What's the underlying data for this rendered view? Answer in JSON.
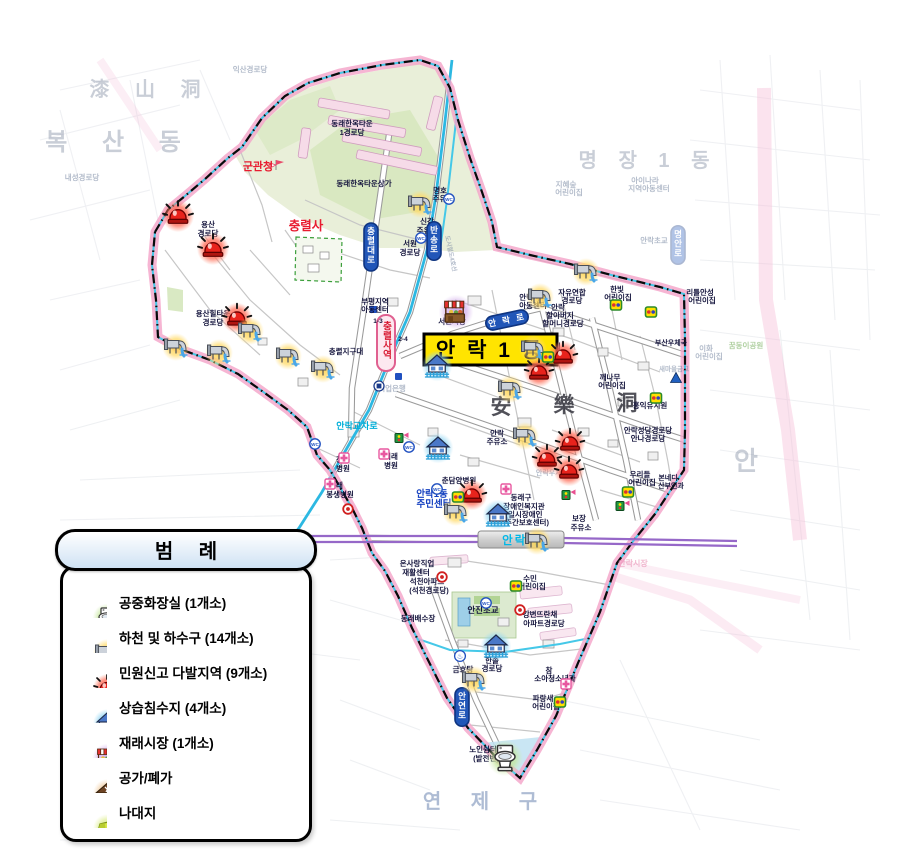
{
  "title": "안 락 1 동",
  "legend": {
    "title": "범 례",
    "items": [
      {
        "icon": "toilet",
        "label": "공중화장실 (1개소)"
      },
      {
        "icon": "drain",
        "label": "하천 및 하수구 (14개소)"
      },
      {
        "icon": "siren",
        "label": "민원신고 다발지역 (9개소)"
      },
      {
        "icon": "flood",
        "label": "상습침수지 (4개소)"
      },
      {
        "icon": "market",
        "label": "재래시장 (1개소)"
      },
      {
        "icon": "vacant-house",
        "label": "공가/폐가"
      },
      {
        "icon": "vacant-land",
        "label": "나대지"
      }
    ]
  },
  "icons": {
    "wc": "WC",
    "bath": "♨"
  },
  "map": {
    "stations": [
      {
        "name": "충렬사역",
        "line": "도시철도4호선"
      },
      {
        "name": "안락역"
      }
    ],
    "road_signs": [
      {
        "text": "안락로",
        "x": 507,
        "y": 320,
        "rot": -12
      },
      {
        "text": "충렬대로",
        "x": 371,
        "y": 247,
        "vert": true
      },
      {
        "text": "반송로",
        "x": 434,
        "y": 241,
        "vert": true
      },
      {
        "text": "안연로",
        "x": 462,
        "y": 707,
        "vert": true
      },
      {
        "text": "명안로",
        "x": 678,
        "y": 245,
        "vert": true,
        "faded": true
      }
    ],
    "labels": [
      {
        "t": "복 산 동",
        "x": 120,
        "y": 150,
        "c": "bg",
        "s": 24,
        "ls": 14
      },
      {
        "t": "漆 山 洞",
        "x": 150,
        "y": 96,
        "c": "bg",
        "s": 20,
        "ls": 10
      },
      {
        "t": "명 장 1 동",
        "x": 648,
        "y": 167,
        "c": "bg",
        "s": 20,
        "ls": 8
      },
      {
        "t": "안",
        "x": 746,
        "y": 470,
        "c": "bg",
        "s": 26
      },
      {
        "t": "연 제 구",
        "x": 486,
        "y": 808,
        "c": "bgb",
        "s": 20,
        "ls": 12
      },
      {
        "t": "安",
        "x": 501,
        "y": 414,
        "c": "hanja",
        "s": 21
      },
      {
        "t": "樂",
        "x": 564,
        "y": 412,
        "c": "hanja",
        "s": 21
      },
      {
        "t": "洞",
        "x": 627,
        "y": 410,
        "c": "hanja",
        "s": 21
      },
      {
        "t": "군관청",
        "x": 258,
        "y": 170,
        "c": "red",
        "s": 11
      },
      {
        "t": "충렬사",
        "x": 306,
        "y": 230,
        "c": "red",
        "s": 12.5
      },
      {
        "t": "안락교차로",
        "x": 357,
        "y": 429,
        "c": "cyan",
        "s": 9
      },
      {
        "t": "안락1동",
        "x": 432,
        "y": 497,
        "c": "blue",
        "s": 9.5
      },
      {
        "t": "주민센터",
        "x": 434,
        "y": 507,
        "c": "blue",
        "s": 9.5
      },
      {
        "t": "동래한옥타운",
        "x": 352,
        "y": 126,
        "c": "f",
        "s": 7.5
      },
      {
        "t": "1경로당",
        "x": 352,
        "y": 135,
        "c": "f",
        "s": 7.5
      },
      {
        "t": "동래한옥타운상가",
        "x": 364,
        "y": 186,
        "c": "f",
        "s": 7.5
      },
      {
        "t": "용산",
        "x": 208,
        "y": 227,
        "c": "f",
        "s": 7.5
      },
      {
        "t": "경로당",
        "x": 208,
        "y": 236,
        "c": "f",
        "s": 7.5
      },
      {
        "t": "용산힐타운",
        "x": 213,
        "y": 316,
        "c": "f",
        "s": 7.5
      },
      {
        "t": "경로당",
        "x": 213,
        "y": 325,
        "c": "f",
        "s": 7.5
      },
      {
        "t": "명호",
        "x": 440,
        "y": 193,
        "c": "f",
        "s": 7.5
      },
      {
        "t": "주유소",
        "x": 443,
        "y": 201,
        "c": "f",
        "s": 7.5
      },
      {
        "t": "신강",
        "x": 427,
        "y": 224,
        "c": "f",
        "s": 7.5
      },
      {
        "t": "주유소",
        "x": 427,
        "y": 233,
        "c": "f",
        "s": 7.5
      },
      {
        "t": "서원",
        "x": 410,
        "y": 246,
        "c": "f",
        "s": 7.5
      },
      {
        "t": "경로당",
        "x": 410,
        "y": 255,
        "c": "f",
        "s": 7.5
      },
      {
        "t": "부평지역",
        "x": 375,
        "y": 304,
        "c": "f",
        "s": 7.5
      },
      {
        "t": "아동센터",
        "x": 375,
        "y": 312,
        "c": "f",
        "s": 7.5
      },
      {
        "t": "1-3",
        "x": 378,
        "y": 323,
        "c": "f",
        "s": 6.5
      },
      {
        "t": "2-4",
        "x": 403,
        "y": 341,
        "c": "f",
        "s": 6.5
      },
      {
        "t": "도시철도4호선",
        "x": 449,
        "y": 254,
        "c": "fd",
        "s": 6,
        "r": 78
      },
      {
        "t": "충렬지구대",
        "x": 346,
        "y": 354,
        "c": "f",
        "s": 7.5
      },
      {
        "t": "기업은행",
        "x": 392,
        "y": 391,
        "c": "fd",
        "s": 7.5
      },
      {
        "t": "서원시장",
        "x": 452,
        "y": 324,
        "c": "f",
        "s": 7.5
      },
      {
        "t": "안락지역",
        "x": 533,
        "y": 300,
        "c": "f",
        "s": 7.5
      },
      {
        "t": "아동센터",
        "x": 533,
        "y": 308,
        "c": "f",
        "s": 7.5
      },
      {
        "t": "자유연합",
        "x": 572,
        "y": 295,
        "c": "f",
        "s": 7.5
      },
      {
        "t": "경로당",
        "x": 572,
        "y": 303,
        "c": "f",
        "s": 7.5
      },
      {
        "t": "한빛",
        "x": 617,
        "y": 292,
        "c": "f",
        "s": 7.5
      },
      {
        "t": "어린이집",
        "x": 618,
        "y": 300,
        "c": "f",
        "s": 7.5
      },
      {
        "t": "안락",
        "x": 558,
        "y": 310,
        "c": "f",
        "s": 7.5
      },
      {
        "t": "할아버지",
        "x": 560,
        "y": 318,
        "c": "f",
        "s": 7.5
      },
      {
        "t": "할머니경로당",
        "x": 563,
        "y": 326,
        "c": "f",
        "s": 7.5
      },
      {
        "t": "리틀안성",
        "x": 700,
        "y": 295,
        "c": "f",
        "s": 7.5
      },
      {
        "t": "어린이집",
        "x": 702,
        "y": 303,
        "c": "f",
        "s": 7.5
      },
      {
        "t": "꾸러기",
        "x": 545,
        "y": 341,
        "c": "f",
        "s": 7.5
      },
      {
        "t": "어린이집",
        "x": 547,
        "y": 349,
        "c": "f",
        "s": 7.5
      },
      {
        "t": "깨나무",
        "x": 610,
        "y": 380,
        "c": "f",
        "s": 7.5
      },
      {
        "t": "어린이집",
        "x": 612,
        "y": 388,
        "c": "f",
        "s": 7.5
      },
      {
        "t": "홍익유치원",
        "x": 650,
        "y": 408,
        "c": "f",
        "s": 7.5
      },
      {
        "t": "부산우체국",
        "x": 671,
        "y": 345,
        "c": "f",
        "s": 7
      },
      {
        "t": "새마을금고",
        "x": 674,
        "y": 371,
        "c": "fd",
        "s": 6.5
      },
      {
        "t": "안락성당경로당",
        "x": 648,
        "y": 433,
        "c": "f",
        "s": 7.5
      },
      {
        "t": "안나경로당",
        "x": 648,
        "y": 441,
        "c": "f",
        "s": 7.5
      },
      {
        "t": "우리들",
        "x": 640,
        "y": 477,
        "c": "f",
        "s": 7.5
      },
      {
        "t": "어린이집",
        "x": 642,
        "y": 485,
        "c": "f",
        "s": 7.5
      },
      {
        "t": "본네디",
        "x": 668,
        "y": 480,
        "c": "f",
        "s": 7
      },
      {
        "t": "산부인과",
        "x": 671,
        "y": 488,
        "c": "f",
        "s": 7
      },
      {
        "t": "안락",
        "x": 497,
        "y": 436,
        "c": "f",
        "s": 7.5
      },
      {
        "t": "주유소",
        "x": 497,
        "y": 444,
        "c": "f",
        "s": 7.5
      },
      {
        "t": "안락우체국",
        "x": 552,
        "y": 475,
        "c": "fd",
        "s": 7
      },
      {
        "t": "미래",
        "x": 391,
        "y": 459,
        "c": "f",
        "s": 7.5
      },
      {
        "t": "병원",
        "x": 391,
        "y": 468,
        "c": "f",
        "s": 7.5
      },
      {
        "t": "창운",
        "x": 343,
        "y": 462,
        "c": "f",
        "s": 7.5
      },
      {
        "t": "병원",
        "x": 343,
        "y": 471,
        "c": "f",
        "s": 7.5
      },
      {
        "t": "동래",
        "x": 336,
        "y": 488,
        "c": "f",
        "s": 7.5
      },
      {
        "t": "봉생병원",
        "x": 340,
        "y": 497,
        "c": "f",
        "s": 7.5
      },
      {
        "t": "춘담양병원",
        "x": 459,
        "y": 483,
        "c": "f",
        "s": 7.5
      },
      {
        "t": "동래구",
        "x": 521,
        "y": 500,
        "c": "f",
        "s": 7.5
      },
      {
        "t": "장애인복지관",
        "x": 524,
        "y": 509,
        "c": "f",
        "s": 7.5
      },
      {
        "t": "(일시장애인",
        "x": 524,
        "y": 517,
        "c": "f",
        "s": 7.5
      },
      {
        "t": "주간보호센터)",
        "x": 527,
        "y": 525,
        "c": "f",
        "s": 7.5
      },
      {
        "t": "보장",
        "x": 579,
        "y": 521,
        "c": "f",
        "s": 7.5
      },
      {
        "t": "주유소",
        "x": 581,
        "y": 530,
        "c": "f",
        "s": 7.5
      },
      {
        "t": "온사랑직업",
        "x": 417,
        "y": 566,
        "c": "f",
        "s": 7.5
      },
      {
        "t": "재활센터",
        "x": 416,
        "y": 575,
        "c": "f",
        "s": 7.5
      },
      {
        "t": "석천아파트",
        "x": 427,
        "y": 584,
        "c": "f",
        "s": 7.5
      },
      {
        "t": "(석천경로당)",
        "x": 429,
        "y": 593,
        "c": "f",
        "s": 7.5
      },
      {
        "t": "수민",
        "x": 530,
        "y": 581,
        "c": "f",
        "s": 7.5
      },
      {
        "t": "어린이집",
        "x": 532,
        "y": 589,
        "c": "f",
        "s": 7.5
      },
      {
        "t": "안진초교",
        "x": 483,
        "y": 613,
        "c": "f",
        "s": 8.5
      },
      {
        "t": "동래배수장",
        "x": 418,
        "y": 621,
        "c": "f",
        "s": 7.5
      },
      {
        "t": "강변뜨란채",
        "x": 540,
        "y": 617,
        "c": "f",
        "s": 7.5
      },
      {
        "t": "아파트경로당",
        "x": 544,
        "y": 626,
        "c": "f",
        "s": 7.5
      },
      {
        "t": "금호탕",
        "x": 463,
        "y": 672,
        "c": "f",
        "s": 7.5
      },
      {
        "t": "한솔",
        "x": 492,
        "y": 663,
        "c": "f",
        "s": 7.5
      },
      {
        "t": "경로당",
        "x": 492,
        "y": 671,
        "c": "f",
        "s": 7.5
      },
      {
        "t": "참",
        "x": 549,
        "y": 673,
        "c": "f",
        "s": 7.5
      },
      {
        "t": "소아청소년과",
        "x": 555,
        "y": 681,
        "c": "f",
        "s": 7.5
      },
      {
        "t": "파랑새",
        "x": 543,
        "y": 701,
        "c": "f",
        "s": 7.5
      },
      {
        "t": "어린이집",
        "x": 546,
        "y": 709,
        "c": "f",
        "s": 7.5
      },
      {
        "t": "노인쉼터",
        "x": 483,
        "y": 752,
        "c": "f",
        "s": 7.5
      },
      {
        "t": "(발전변)",
        "x": 486,
        "y": 761,
        "c": "f",
        "s": 7.5
      },
      {
        "t": "익산경로당",
        "x": 250,
        "y": 72,
        "c": "fd",
        "s": 7.5
      },
      {
        "t": "내성경로당",
        "x": 82,
        "y": 180,
        "c": "fd",
        "s": 7.5
      },
      {
        "t": "아이나라",
        "x": 645,
        "y": 183,
        "c": "fd",
        "s": 7.5
      },
      {
        "t": "지역아동센터",
        "x": 649,
        "y": 191,
        "c": "fd",
        "s": 7.5
      },
      {
        "t": "지혜숲",
        "x": 566,
        "y": 187,
        "c": "fd",
        "s": 7.5
      },
      {
        "t": "어린이집",
        "x": 569,
        "y": 195,
        "c": "fd",
        "s": 7.5
      },
      {
        "t": "안락초교",
        "x": 654,
        "y": 243,
        "c": "fd",
        "s": 7.5
      },
      {
        "t": "이화",
        "x": 706,
        "y": 351,
        "c": "fd",
        "s": 7.5
      },
      {
        "t": "어린이집",
        "x": 709,
        "y": 359,
        "c": "fd",
        "s": 7.5
      },
      {
        "t": "꿈동이공원",
        "x": 746,
        "y": 348,
        "c": "fdg",
        "s": 7.5
      },
      {
        "t": "안락시장",
        "x": 633,
        "y": 566,
        "c": "fdp",
        "s": 8
      }
    ],
    "markers": [
      {
        "k": "siren",
        "x": 178,
        "y": 216,
        "s": 1.15
      },
      {
        "k": "siren",
        "x": 213,
        "y": 249,
        "s": 1.15
      },
      {
        "k": "siren",
        "x": 237,
        "y": 318,
        "s": 1.1
      },
      {
        "k": "siren",
        "x": 539,
        "y": 372,
        "s": 1.1
      },
      {
        "k": "siren",
        "x": 563,
        "y": 356,
        "s": 1.1
      },
      {
        "k": "siren",
        "x": 570,
        "y": 443,
        "s": 1.1
      },
      {
        "k": "siren",
        "x": 547,
        "y": 459,
        "s": 1.1
      },
      {
        "k": "siren",
        "x": 569,
        "y": 471,
        "s": 1.1
      },
      {
        "k": "siren",
        "x": 472,
        "y": 495,
        "s": 1.1
      },
      {
        "k": "drain",
        "x": 420,
        "y": 204
      },
      {
        "k": "drain",
        "x": 586,
        "y": 272
      },
      {
        "k": "drain",
        "x": 540,
        "y": 297
      },
      {
        "k": "drain",
        "x": 533,
        "y": 349
      },
      {
        "k": "drain",
        "x": 510,
        "y": 389
      },
      {
        "k": "drain",
        "x": 250,
        "y": 331
      },
      {
        "k": "drain",
        "x": 288,
        "y": 356
      },
      {
        "k": "drain",
        "x": 323,
        "y": 369
      },
      {
        "k": "drain",
        "x": 176,
        "y": 347
      },
      {
        "k": "drain",
        "x": 219,
        "y": 353
      },
      {
        "k": "drain",
        "x": 525,
        "y": 436
      },
      {
        "k": "drain",
        "x": 456,
        "y": 512
      },
      {
        "k": "drain",
        "x": 537,
        "y": 541
      },
      {
        "k": "drain",
        "x": 474,
        "y": 680
      },
      {
        "k": "flood",
        "x": 437,
        "y": 366,
        "s": 1.1
      },
      {
        "k": "flood",
        "x": 438,
        "y": 448,
        "s": 1.1
      },
      {
        "k": "flood",
        "x": 498,
        "y": 515,
        "s": 1.1
      },
      {
        "k": "flood",
        "x": 496,
        "y": 646,
        "s": 1.1
      },
      {
        "k": "market",
        "x": 456,
        "y": 312,
        "s": 1.2
      },
      {
        "k": "toilet",
        "x": 505,
        "y": 758,
        "s": 1.25
      },
      {
        "k": "kid",
        "x": 616,
        "y": 305
      },
      {
        "k": "kid",
        "x": 651,
        "y": 312
      },
      {
        "k": "kid",
        "x": 548,
        "y": 357
      },
      {
        "k": "kid",
        "x": 656,
        "y": 398
      },
      {
        "k": "kid",
        "x": 516,
        "y": 586
      },
      {
        "k": "kid",
        "x": 560,
        "y": 702
      },
      {
        "k": "kid",
        "x": 628,
        "y": 492
      },
      {
        "k": "kid",
        "x": 458,
        "y": 497
      },
      {
        "k": "wc",
        "x": 449,
        "y": 199
      },
      {
        "k": "wc",
        "x": 421,
        "y": 238
      },
      {
        "k": "wc",
        "x": 409,
        "y": 447
      },
      {
        "k": "wc",
        "x": 437,
        "y": 489
      },
      {
        "k": "wc",
        "x": 486,
        "y": 603
      },
      {
        "k": "wc",
        "x": 315,
        "y": 444
      },
      {
        "k": "hosp",
        "x": 344,
        "y": 458
      },
      {
        "k": "hosp",
        "x": 384,
        "y": 454
      },
      {
        "k": "hosp",
        "x": 330,
        "y": 484
      },
      {
        "k": "hosp",
        "x": 506,
        "y": 489
      },
      {
        "k": "hosp",
        "x": 566,
        "y": 684
      },
      {
        "k": "sig",
        "x": 399,
        "y": 438
      },
      {
        "k": "sig",
        "x": 566,
        "y": 495
      },
      {
        "k": "sig",
        "x": 620,
        "y": 506
      },
      {
        "k": "sch",
        "x": 442,
        "y": 577
      },
      {
        "k": "sch",
        "x": 520,
        "y": 610
      },
      {
        "k": "sch",
        "x": 348,
        "y": 509
      },
      {
        "k": "tri",
        "x": 676,
        "y": 378
      },
      {
        "k": "bath",
        "x": 460,
        "y": 656
      },
      {
        "k": "bank",
        "x": 379,
        "y": 386
      }
    ]
  }
}
